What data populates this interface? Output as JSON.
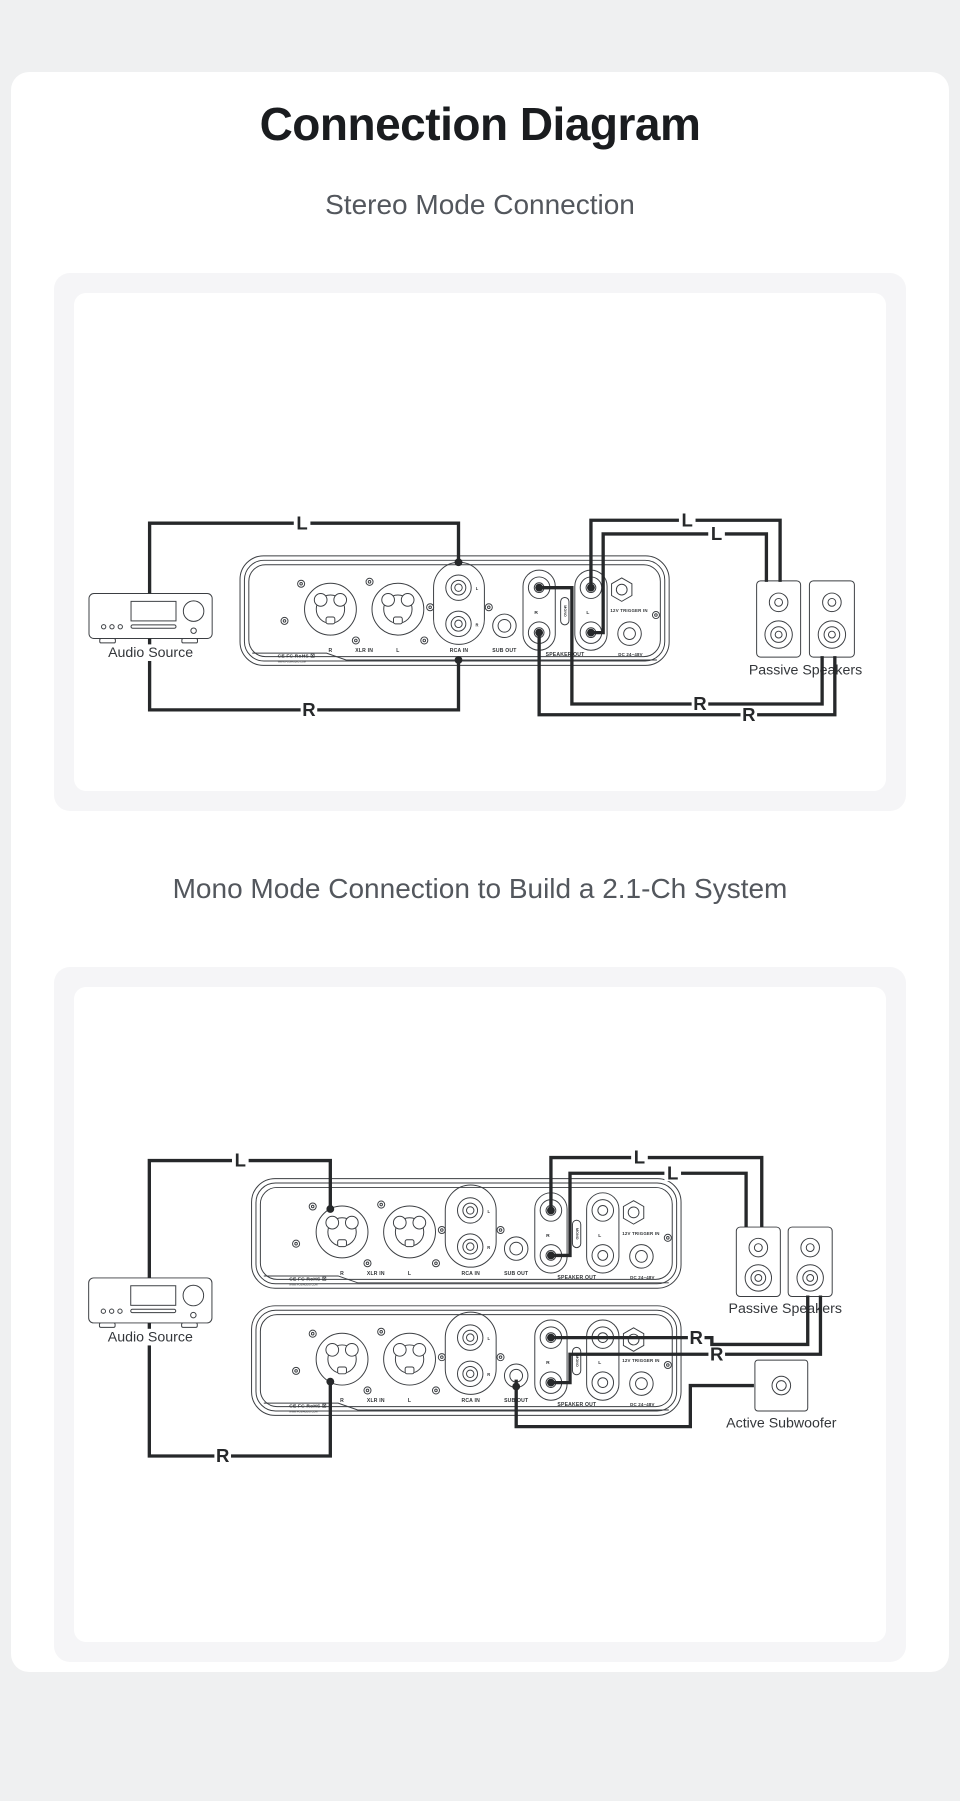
{
  "page": {
    "title": "Connection Diagram",
    "section1": "Stereo Mode Connection",
    "section2": "Mono Mode Connection to Build a 2.1-Ch System"
  },
  "colors": {
    "page_bg": "#eff0f1",
    "card_bg": "#ffffff",
    "panel_bg": "#f5f5f7",
    "wire": "#26282a",
    "line_art": "#3b3e42",
    "title_text": "#1a1c1f",
    "heading_text": "#53575d"
  },
  "amp_panel": {
    "xlr_left_label": "R",
    "xlr_label": "XLR IN",
    "xlr_right_label": "L",
    "rca_top_label": "L",
    "rca_bottom_label": "R",
    "rca_label": "RCA IN",
    "sub_label": "SUB OUT",
    "speaker_left_label": "R",
    "speaker_right_label": "L",
    "mono_label": "MONO",
    "speaker_label": "SPEAKER OUT",
    "trigger_label": "12V TRIGGER IN",
    "power_label": "DC 24~48V",
    "cert_label": "CE FC RoHS ☒",
    "website_label": "WWW.FOSIAUDIO.COM"
  },
  "diagram1": {
    "audio_source_label": "Audio Source",
    "passive_speakers_label": "Passive Speakers",
    "wires": {
      "l_in": "L",
      "r_in": "R",
      "l_out1": "L",
      "l_out2": "L",
      "r_out1": "R",
      "r_out2": "R"
    }
  },
  "diagram2": {
    "audio_source_label": "Audio Source",
    "passive_speakers_label": "Passive Speakers",
    "active_subwoofer_label": "Active Subwoofer",
    "wires": {
      "l_in": "L",
      "r_in": "R",
      "l_out1": "L",
      "l_out2": "L",
      "r_out1": "R",
      "r_out2": "R"
    }
  }
}
